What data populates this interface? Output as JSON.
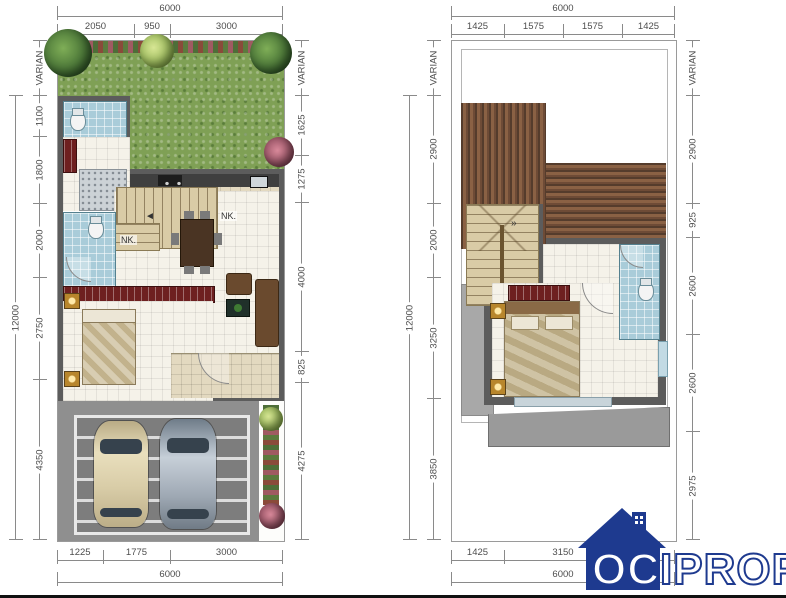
{
  "meta": {
    "varian": "VARIAN",
    "colors": {
      "logo_blue": "#1e3a8f",
      "roof_brown": "#6e4b36",
      "grass_green": "#7fa055",
      "tile_blue": "#a9ccd9",
      "wall_gray": "#5c5c5c",
      "stair_tan": "#d9cba6"
    }
  },
  "ground_floor": {
    "dims": {
      "top_total": "6000",
      "top": [
        "2050",
        "950",
        "3000"
      ],
      "left_total": "12000",
      "left": [
        "1100",
        "1800",
        "2000",
        "2750",
        "4350"
      ],
      "right": [
        "1625",
        "1275",
        "4000",
        "825",
        "4275"
      ],
      "bottom": [
        "1225",
        "1775",
        "3000"
      ],
      "bottom_total": "6000"
    },
    "labels": {
      "nk1": "NK.",
      "nk2": "NK."
    }
  },
  "upper_floor": {
    "dims": {
      "top_total": "6000",
      "top": [
        "1425",
        "1575",
        "1575",
        "1425"
      ],
      "left_total": "12000",
      "left": [
        "2900",
        "2000",
        "3250",
        "3850"
      ],
      "right": [
        "2900",
        "925",
        "2600",
        "2600",
        "2975"
      ],
      "bottom": [
        "1425",
        "3150",
        "1425"
      ],
      "bottom_total": "6000"
    },
    "labels": {
      "tr": "TR."
    }
  },
  "logo": {
    "text": "OCIPROP"
  }
}
